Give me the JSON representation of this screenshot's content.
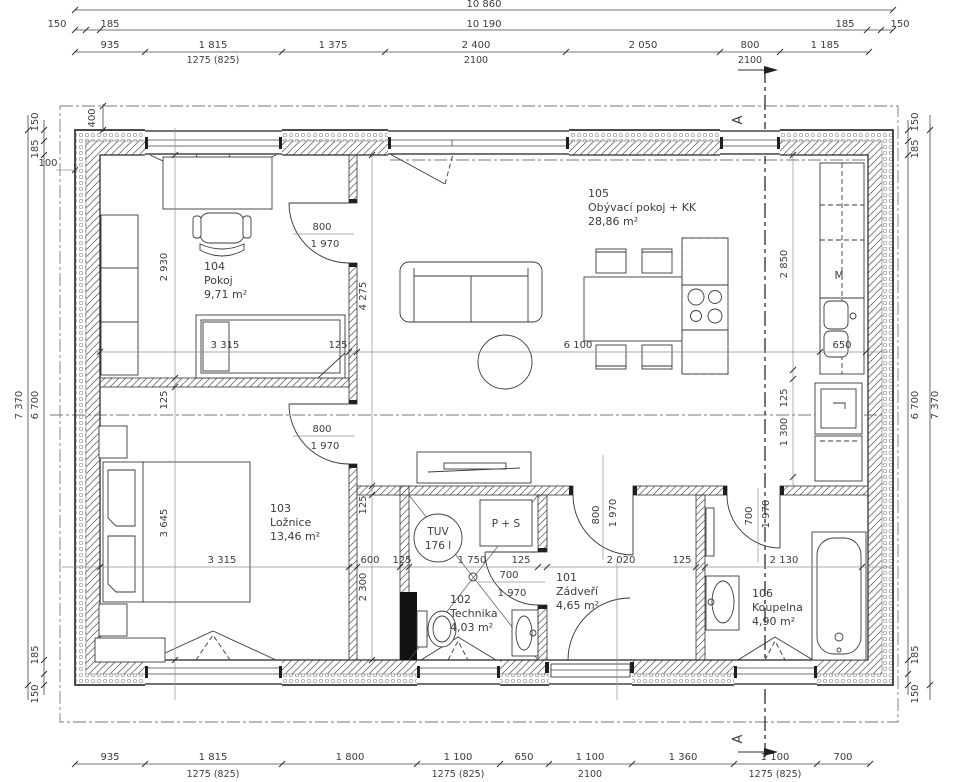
{
  "drawing_type": "house floor plan",
  "colors": {
    "line": "#222222",
    "dim_text": "#3c3c3c",
    "guide_line": "#8f8f8f",
    "axis_line": "#7a7a7a",
    "wall_black": "#111111",
    "background": "#ffffff"
  },
  "rooms": {
    "r104": {
      "num": "104",
      "name": "Pokoj",
      "area": "9,71 m²"
    },
    "r105": {
      "num": "105",
      "name": "Obývací pokoj + KK",
      "area": "28,86 m²"
    },
    "r103": {
      "num": "103",
      "name": "Ložnice",
      "area": "13,46 m²"
    },
    "r101": {
      "num": "101",
      "name": "Zádveří",
      "area": "4,65 m²"
    },
    "r102": {
      "num": "102",
      "name": "Technika",
      "area": "4,03 m²"
    },
    "r106": {
      "num": "106",
      "name": "Koupelna",
      "area": "4,90 m²"
    }
  },
  "fixtures": {
    "tuv": "TUV",
    "tuv_volume": "176 l",
    "washer_dryer": "P + S",
    "appliance_m": "M"
  },
  "section": {
    "label": "A"
  },
  "labels": {
    "d10860": "10 860",
    "d10190": "10 190",
    "d150": "150",
    "d185": "185",
    "d935": "935",
    "d1815": "1 815",
    "d1275": "1275 (825)",
    "d1375": "1 375",
    "d2400": "2 400",
    "d2100": "2100",
    "d2050": "2 050",
    "d800": "800",
    "d1185": "1 185",
    "d1800": "1 800",
    "d1100": "1 100",
    "d650": "650",
    "d1360": "1 360",
    "d700": "700",
    "d7370": "7 370",
    "d6700": "6 700",
    "d400": "400",
    "d100": "100",
    "d2930": "2 930",
    "d3315": "3 315",
    "d125": "125",
    "d6100": "6 100",
    "d3645": "3 645",
    "d600": "600",
    "d2300": "2 300",
    "d1750": "1 750",
    "d2020": "2 020",
    "d2130": "2 130",
    "d1970": "1 970",
    "d4275": "4 275",
    "d2850": "2 850",
    "d1300": "1 300"
  }
}
